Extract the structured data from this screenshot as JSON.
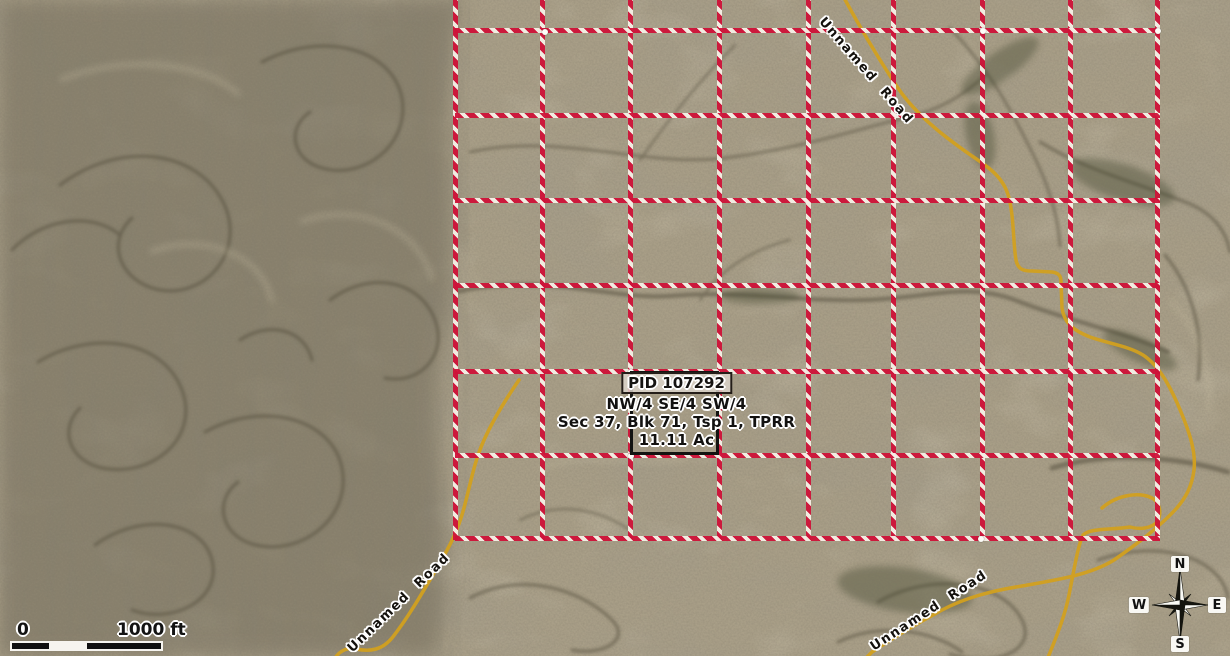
{
  "frame": {
    "width": 1230,
    "height": 656
  },
  "parcel": {
    "pid": "PID 107292",
    "line1": "NW/4 SE/4 SW/4",
    "line2": "Sec 37, Blk 71, Tsp 1, TPRR",
    "line3": "11.11 Ac",
    "box": {
      "x": 630,
      "y": 371,
      "w": 89,
      "h": 84
    }
  },
  "grid": {
    "red": "#ce1238",
    "white": "#f5f0e6",
    "top": 0,
    "bottom": 540,
    "left": 455,
    "right": 1160,
    "vertical_x": [
      455,
      542,
      630,
      719,
      808,
      893,
      982,
      1070,
      1157
    ],
    "horizontal_y": [
      30,
      115,
      200,
      285,
      371,
      455,
      538
    ],
    "vertex_dots": [
      {
        "x": 545,
        "y": 32
      },
      {
        "x": 983,
        "y": 31
      },
      {
        "x": 1158,
        "y": 31
      },
      {
        "x": 631,
        "y": 372
      },
      {
        "x": 631,
        "y": 456
      },
      {
        "x": 981,
        "y": 539
      }
    ]
  },
  "roads": {
    "color": "#d2a01f",
    "labels": [
      {
        "text": "Unnamed Road",
        "cx": 866,
        "cy": 71,
        "angle": 49
      },
      {
        "text": "Unnamed Road",
        "cx": 399,
        "cy": 603,
        "angle": -44
      },
      {
        "text": "Unnamed Road",
        "cx": 929,
        "cy": 611,
        "angle": -33
      }
    ]
  },
  "scalebar": {
    "zero": "0",
    "label": "1000 ft"
  },
  "compass": {
    "n": "N",
    "e": "E",
    "s": "S",
    "w": "W"
  }
}
